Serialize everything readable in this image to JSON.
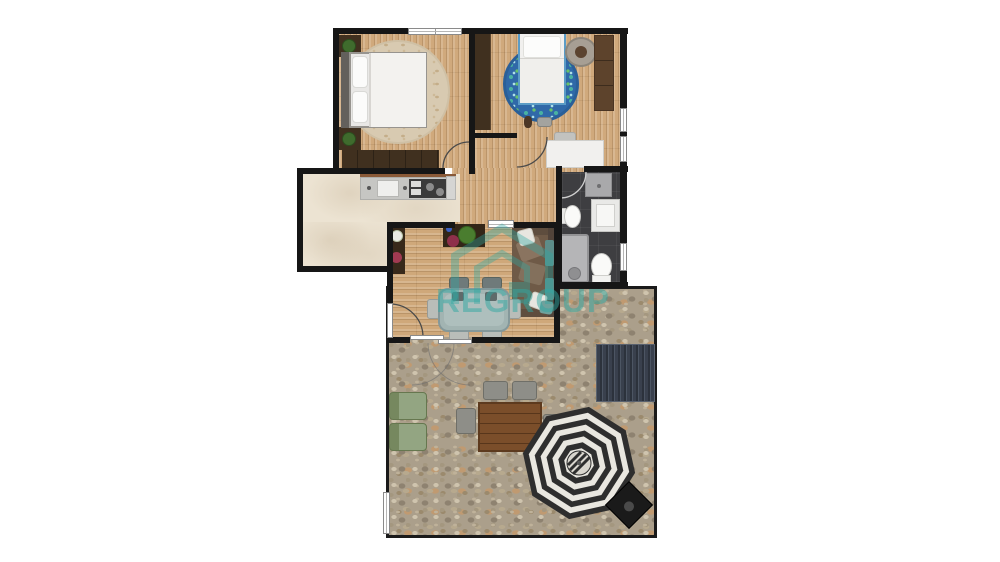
{
  "watermark": {
    "brand": "REGROUP",
    "color": "#2fa8a2"
  },
  "floorplan": {
    "rooms": [
      {
        "id": "bedroom-left",
        "floor": "wood",
        "furniture": [
          "double-bed",
          "nightstand-with-plant",
          "nightstand-with-plant",
          "round-beige-rug",
          "wardrobe",
          "window",
          "door"
        ]
      },
      {
        "id": "bedroom-right",
        "floor": "wood",
        "furniture": [
          "single-bed",
          "round-patterned-rug",
          "wardrobe",
          "round-lounge-chair",
          "tall-shelf",
          "desk",
          "desk-chair",
          "teddy-bear",
          "game-controller",
          "windows",
          "door"
        ]
      },
      {
        "id": "kitchen",
        "floor": "cream-tile",
        "furniture": [
          "counter",
          "sink",
          "cooktop",
          "fridge-module"
        ]
      },
      {
        "id": "hallway",
        "floor": "wood",
        "furniture": []
      },
      {
        "id": "bathroom",
        "floor": "dark-tile",
        "furniture": [
          "shower-tray",
          "bidet",
          "vanity-sink",
          "bathtub-with-shower",
          "toilet",
          "window",
          "door"
        ]
      },
      {
        "id": "living-dining",
        "floor": "wood",
        "furniture": [
          "corner-sofa",
          "teal-cushions",
          "white-pillows",
          "dining-table",
          "dining-chairs",
          "media-console",
          "potted-plants",
          "plant-shelf",
          "sliding-glass-door",
          "entry-door"
        ]
      },
      {
        "id": "patio",
        "floor": "stone",
        "furniture": [
          "solar-panel",
          "garden-armchair",
          "garden-armchair",
          "outdoor-wood-table",
          "outdoor-chairs",
          "striped-parasol",
          "grill",
          "side-window"
        ]
      }
    ]
  },
  "palette": {
    "wall": "#161616",
    "wood_floor": "#d0a97c",
    "kitchen_tile": "#ece3d2",
    "bathroom_tile": "#3e3e41",
    "stone": "#ab9f8b",
    "accent_teal": "#2fa8a2",
    "rug_blue": "#3069a8",
    "sofa_brown": "#6f5a47"
  }
}
